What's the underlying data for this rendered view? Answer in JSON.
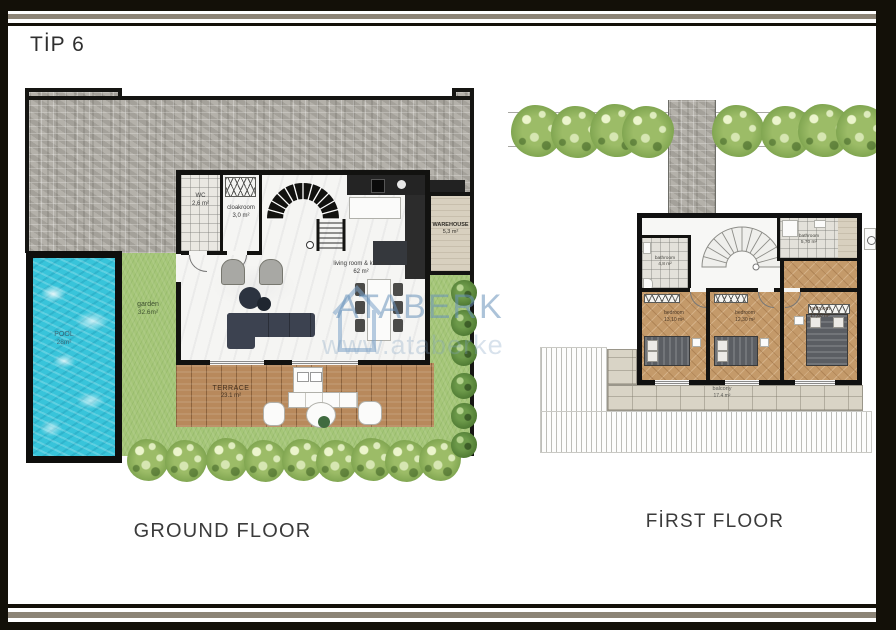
{
  "title": "TİP 6",
  "watermark": {
    "brand": "ATABERK",
    "url_text": "www.ataberke"
  },
  "ground_floor": {
    "caption": "GROUND FLOOR",
    "rooms": {
      "wc": {
        "name": "WC",
        "area": "2,6 m²"
      },
      "cloakroom": {
        "name": "cloakroom",
        "area": "3,0 m²"
      },
      "living_kitchen": {
        "name": "living room & kitchen",
        "area": "62 m²"
      },
      "warehouse": {
        "name": "WAREHOUSE",
        "area": "5,3 m²"
      },
      "garden": {
        "name": "garden",
        "area": "32.6m²"
      },
      "pool": {
        "name": "POOL",
        "area": "28m²"
      },
      "terrace": {
        "name": "TERRACE",
        "area": "23.1 m²"
      }
    }
  },
  "first_floor": {
    "caption": "FİRST FLOOR",
    "rooms": {
      "bathroom_small": {
        "name": "bathroom",
        "area": "4,8 m²"
      },
      "bathroom_large": {
        "name": "bathroom",
        "area": "5,70 m²"
      },
      "bedroom_1": {
        "name": "bedroom",
        "area": "13,10 m²"
      },
      "bedroom_2": {
        "name": "bedroom",
        "area": "12,30 m²"
      },
      "bedroom_3": {
        "name": "bedroom",
        "area": "17,60 m²"
      },
      "balcony": {
        "name": "balcony",
        "area": "17.4 m²"
      }
    }
  },
  "colors": {
    "pool_water": "#38c4da",
    "grass": "#a5c678",
    "stone": "#b2afa8",
    "wood_deck": "#b8895c",
    "wood_floor": "#c49a6a",
    "wall": "#121210",
    "watermark_blue": "#6891ba",
    "frame_stripe": "#8c8476"
  }
}
